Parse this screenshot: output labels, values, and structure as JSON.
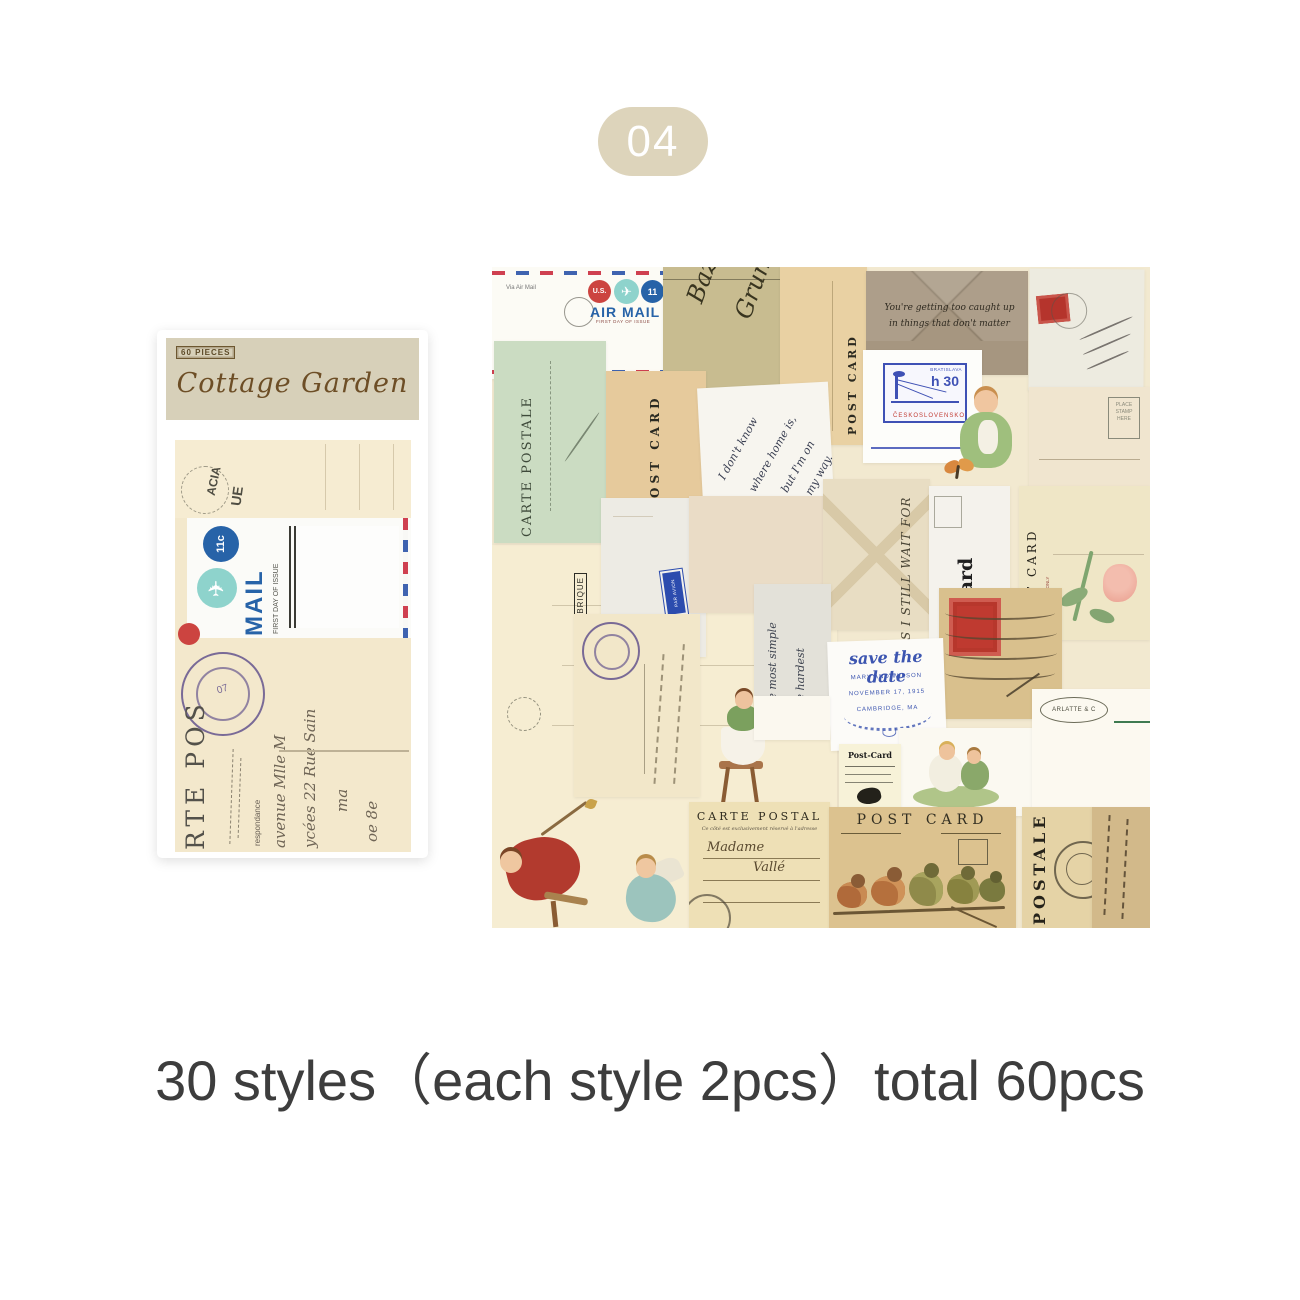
{
  "badge": {
    "label": "04"
  },
  "caption": {
    "text": "30 styles（each style 2pcs）total 60pcs"
  },
  "package": {
    "count_label": "60 PIECES",
    "title": "Cottage Garden",
    "window": {
      "mark1": "ACIA",
      "mark2": "UE",
      "airmail": {
        "value": "11c",
        "plane": "✈",
        "mail": "MAIL",
        "first_day": "FIRST DAY OF ISSUE"
      },
      "carte": "RTE POS",
      "resp": "respondance",
      "s1": "avenue  Mlle M",
      "s2": "ycées  22 Rue Sain",
      "s3": "ma",
      "s4": "oe 8e",
      "postmark": "07"
    }
  },
  "collage": {
    "airmail_envelope": {
      "us": "U.S.",
      "value": "11",
      "plane": "✈",
      "title": "AIR MAIL",
      "subtitle": "FIRST DAY OF ISSUE",
      "corner": "Via Air Mail"
    },
    "olive_paper": {
      "w1": "Bazal",
      "w2": "Grund"
    },
    "tan_postcard": {
      "title": "POST CARD"
    },
    "kraft_envelope": {
      "line1": "You're getting too caught up",
      "line2": "in things that don't matter"
    },
    "h30_card": {
      "city": "BRATISLAVA",
      "value": "h 30",
      "country": "ČESKOSLOVENSKO"
    },
    "lined_postcard": {
      "l1": "PLACE",
      "l2": "STAMP",
      "l3": "HERE"
    },
    "green_carte": {
      "title": "CARTE POSTALE"
    },
    "small_tan_postcard": {
      "title": "POST CARD"
    },
    "white_note": {
      "l1": "I don't know",
      "l2": "where home is,",
      "l3": "but I'm on",
      "l4": "my way."
    },
    "par_avion": {
      "label": "PAR AVION"
    },
    "still_wait": {
      "text": "S I STILL WAIT FOR"
    },
    "gothic_card": {
      "title": "Post Card",
      "side": "FOR ADDRESS ONLY"
    },
    "rose_card": {
      "title": "POST CARD",
      "side": "FOR ADDRESS ONLY"
    },
    "gray_script": {
      "l1": "The most simple",
      "l2": "the hardest"
    },
    "save_card": {
      "title": "save the date",
      "names": "MARY AND WILSON",
      "date": "NOVEMBER 17, 1915",
      "place": "CAMBRIDGE, MA"
    },
    "fragment_card": {
      "title": "Post-Card"
    },
    "arlatte_card": {
      "stamp": "ARLATTE & C"
    },
    "carte_postal": {
      "title": "CARTE POSTAL",
      "subtitle": "Ce côté est exclusivement réservé à l'adresse",
      "script1": "Madame",
      "script2": "Vallé"
    },
    "birds_card": {
      "title": "POST CARD"
    },
    "postale_strip": {
      "title": "POSTALE"
    },
    "fabrique": {
      "l1": "ATELIERS",
      "l2": "FABRIQUE"
    }
  }
}
